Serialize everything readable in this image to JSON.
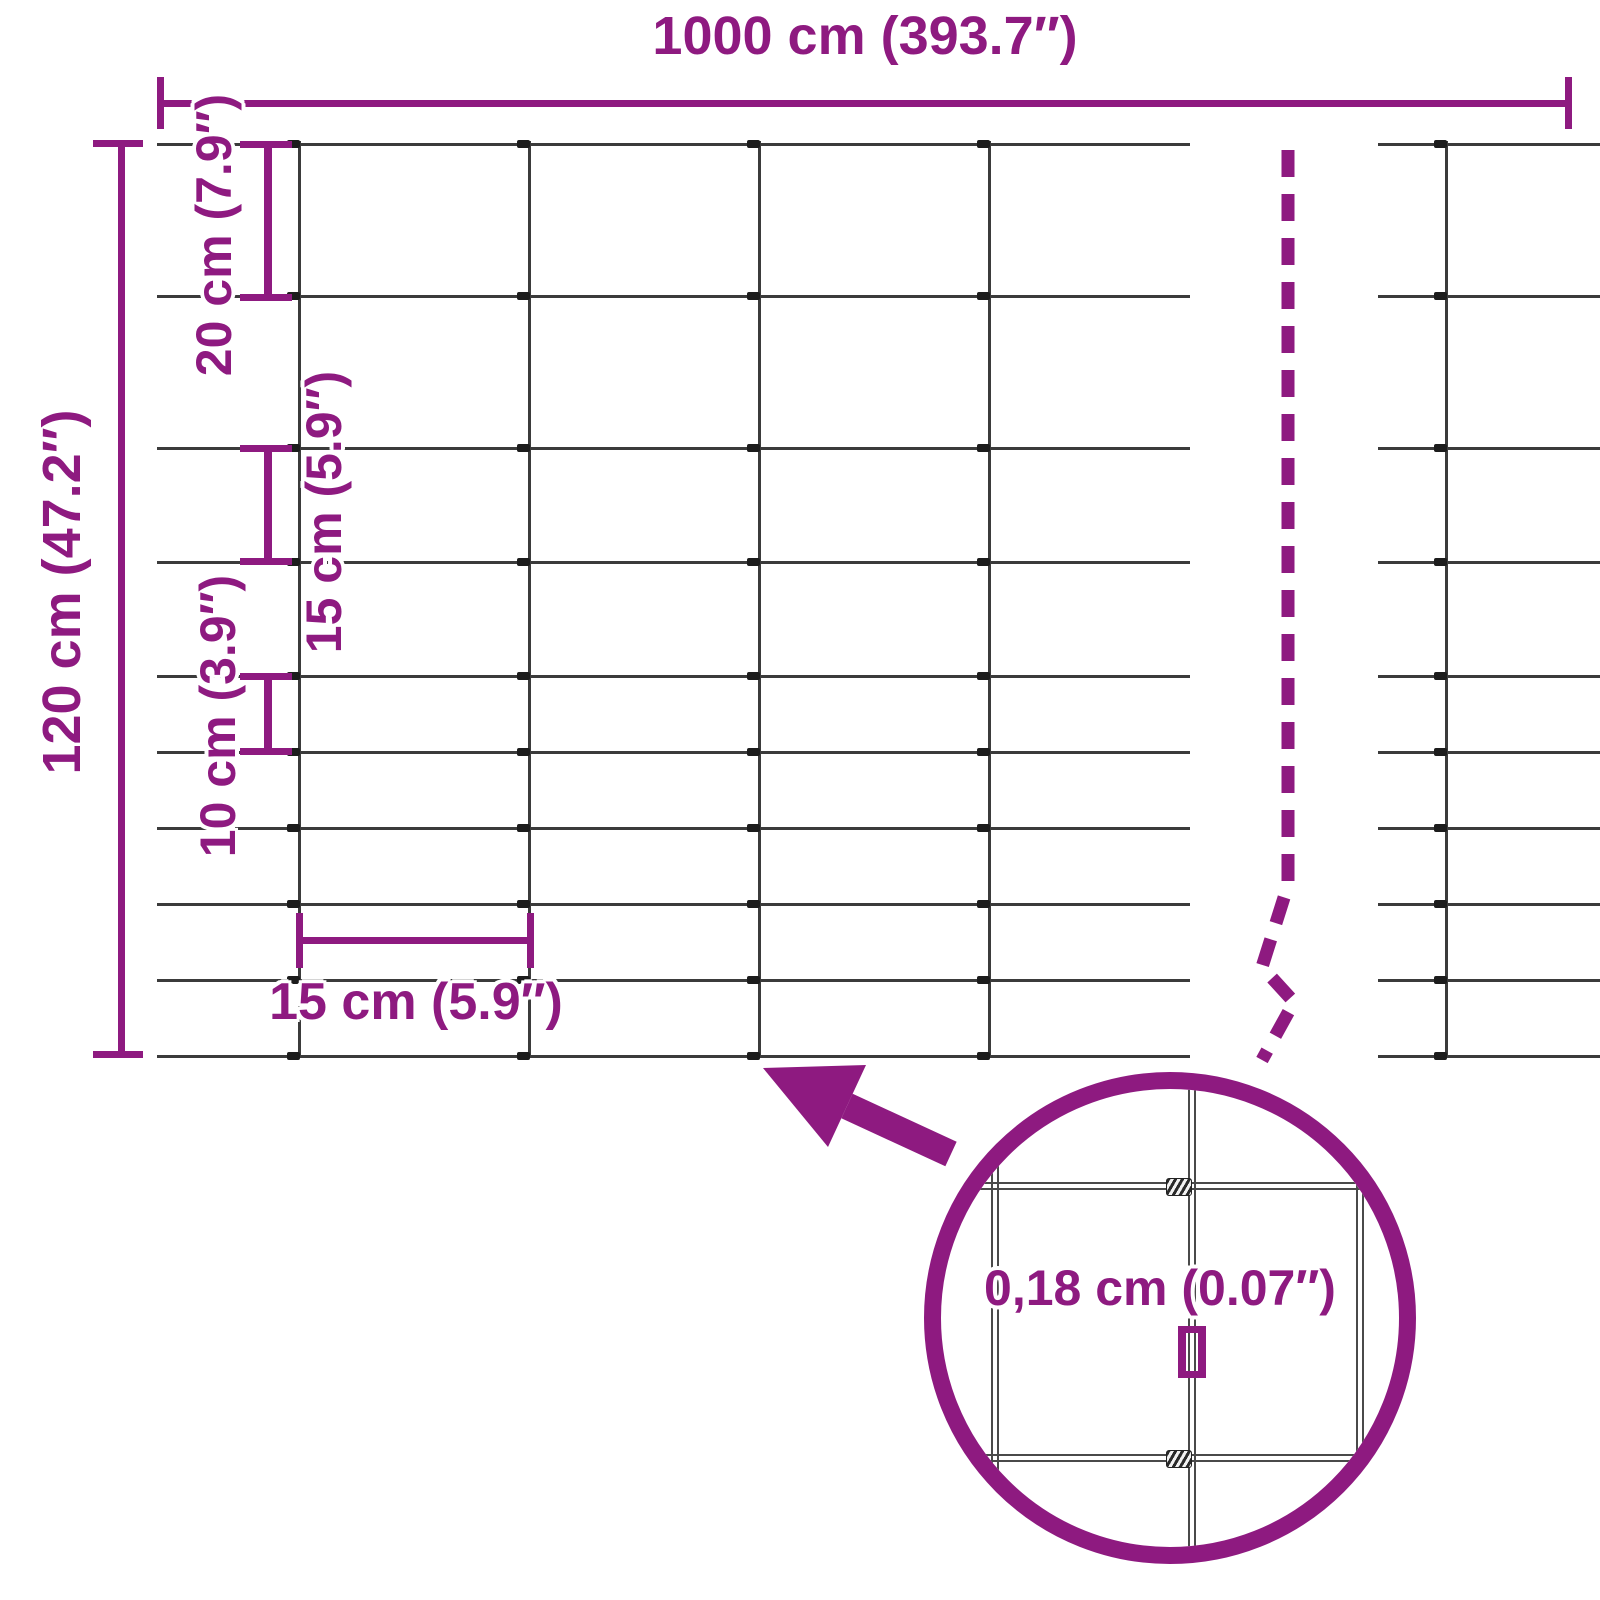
{
  "title": "Wire mesh fence dimension diagram",
  "colors": {
    "accent": "#8e1a80",
    "wire": "#3b3b3b",
    "knot": "#1c1c1c"
  },
  "labels": {
    "total_width": "1000 cm (393.7″)",
    "total_height": "120 cm (47.2″)",
    "row_gap_top": "20 cm (7.9″)",
    "row_gap_mid": "15 cm (5.9″)",
    "row_gap_low": "10 cm (3.9″)",
    "col_gap": "15 cm (5.9″)",
    "wire_thickness": "0,18 cm (0.07″)"
  },
  "diagram_data": {
    "type": "dimension-diagram",
    "subject": "galvanized wire mesh fence roll",
    "fence_width_cm": 1000,
    "fence_height_cm": 120,
    "horizontal_wire_count": 10,
    "row_spacings_cm_top_to_bottom": [
      20,
      20,
      15,
      15,
      10,
      10,
      10,
      10,
      10
    ],
    "column_spacing_cm": 15,
    "wire_thickness_cm": 0.18,
    "detail_view": "magnified wire crossing with twisted knot inside circle"
  }
}
